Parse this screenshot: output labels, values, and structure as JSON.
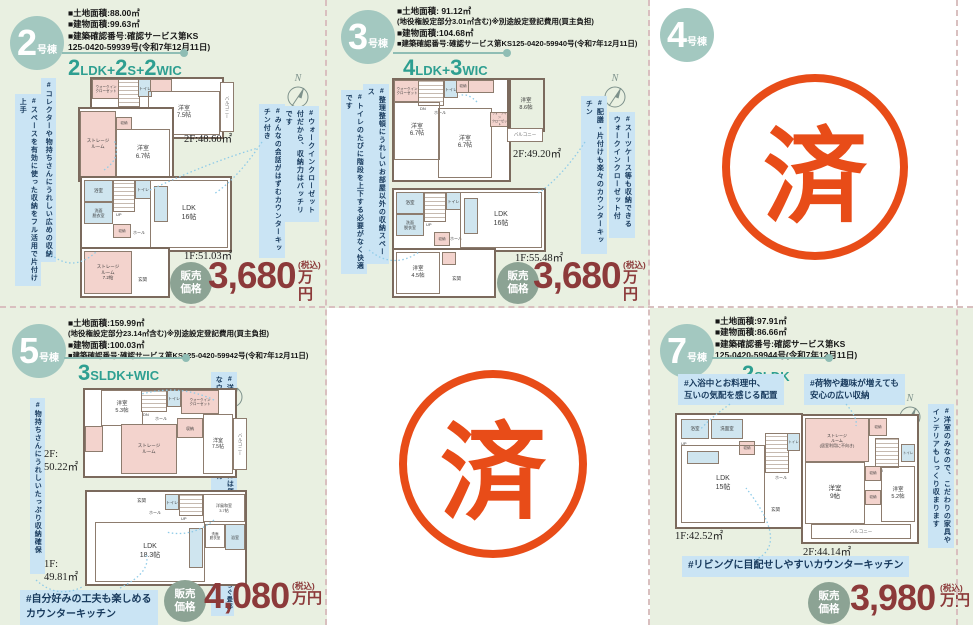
{
  "plus": "+",
  "compass_n": "N",
  "stamp": "済",
  "price_badge": "販売\n価格",
  "units": {
    "u2": {
      "num": "2",
      "suffix": "号棟",
      "specs": [
        "■土地面積:88.00㎡",
        "■建物面積:99.63㎡",
        "■建築確認番号:確認サービス第KS",
        "125-0420-59939号(令和7年12月11日)"
      ],
      "layout": [
        {
          "n": "2",
          "t": "LDK"
        },
        {
          "n": "2",
          "t": "S"
        },
        {
          "n": "2",
          "t": "WIC"
        }
      ],
      "tags": {
        "l1": "#コレクターや物持ちさんにうれしい広めの収納",
        "l2": "#スペースを有効に使った収納をフル活用で片付け上手",
        "r1": "#みんなの会話がはずむカウンターキッチン付き",
        "r2": "#ウォークインクローゼット付だから、収納力はバッチリです"
      },
      "plan2f": {
        "area": "2F:48.60㎡",
        "rooms": {
          "wic1": "ウォークイン\nクローゼット",
          "toilet": "トイレ",
          "dn": "DN",
          "hall": "ホール",
          "r1": "洋室\n7.5帖",
          "storage": "ストレージ\nルーム",
          "closet": "収納",
          "r2": "洋室\n6.7帖",
          "balcony": "バルコニー"
        }
      },
      "plan1f": {
        "area": "1F:51.03㎡",
        "rooms": {
          "bath": "浴室",
          "wash": "洗面\n脱衣室",
          "toilet": "トイレ",
          "up": "UP",
          "closet": "収納",
          "hall": "ホール",
          "ldk": "LDK\n16帖",
          "entry": "玄関",
          "storage": "ストレージ\nルーム\n7.2帖"
        }
      },
      "price": {
        "amount": "3,680",
        "tax": "(税込)",
        "unit": "万円"
      }
    },
    "u3": {
      "num": "3",
      "suffix": "号棟",
      "specs": [
        "■土地面積: 91.12㎡",
        "(地役権設定部分3.01㎡含む)※別途設定登記費用(買主負担)",
        "■建物面積:104.68㎡",
        "■建築確認番号:確認サービス第KS125-0420-59940号(令和7年12月11日)"
      ],
      "layout": [
        {
          "n": "4",
          "t": "LDK"
        },
        {
          "n": "3",
          "t": "WIC"
        }
      ],
      "tags": {
        "l1": "#整理整頓にうれしいお部屋以外の収納スペース",
        "l2": "#トイレのたびに階段を上下する必要がなく快適です",
        "r1": "#配膳・片付けも楽々のカウンターキッチン",
        "r2": "#スーツケース等も収納できるウォークインクローゼット付"
      },
      "plan2f": {
        "area": "2F:49.20㎡",
        "rooms": {
          "wic1": "ウォークイン\nクローゼット",
          "toilet": "トイレ",
          "closet": "収納",
          "r1": "洋室\n6.7帖",
          "r2": "洋室\n6.7帖",
          "r3": "洋室\n8.6帖",
          "wic3": "ウォークイン\nクローゼット",
          "dn": "DN",
          "hall": "ホール",
          "balcony": "バルコニー"
        }
      },
      "plan1f": {
        "area": "1F:55.48㎡",
        "rooms": {
          "bath": "浴室",
          "wash": "洗面\n脱衣室",
          "toilet": "トイレ",
          "up": "UP",
          "closet": "収納",
          "hall": "ホール",
          "ldk": "LDK\n16帖",
          "r1": "洋室\n4.5帖",
          "entry": "玄関"
        }
      },
      "price": {
        "amount": "3,680",
        "tax": "(税込)",
        "unit": "万円"
      }
    },
    "u4": {
      "num": "4",
      "suffix": "号棟"
    },
    "u5": {
      "num": "5",
      "suffix": "号棟",
      "specs": [
        "■土地面積:159.99㎡",
        "(地役権設定部分23.14㎡含む)※別途設定登記費用(買主負担)",
        "■建物面積:100.03㎡",
        "■建築確認番号:確認サービス第KS125-0420-59942号(令和7年12月11日)"
      ],
      "layout": [
        {
          "n": "3",
          "t": "SLDK"
        },
        {
          "n": "",
          "t": "WIC"
        }
      ],
      "tags": {
        "l1": "#物持ちさんにうれしいたっぷり収納確保",
        "r1": "#洋服好きや衣装持ちの方には便利なウォークインクロゼット有",
        "r2": "#ホッと一息、心が安らぐ畳部屋",
        "b1": "#自分好みの工夫も楽しめる\nカウンターキッチン"
      },
      "plan2f": {
        "area": "2F:\n50.22㎡",
        "rooms": {
          "r1": "洋室\n5.3帖",
          "dn": "DN",
          "hall": "ホール",
          "toilet": "トイレ",
          "wic": "ウォークイン\nクローゼット",
          "storage": "ストレージ\nルーム",
          "closet": "収納",
          "r2": "洋室\n7.5帖",
          "balcony": "バルコニー"
        }
      },
      "plan1f": {
        "area": "1F:\n49.81㎡",
        "rooms": {
          "entry": "玄関",
          "toilet": "トイレ",
          "up": "UP",
          "hall": "ホール",
          "sr": "洋風和室\n3.7帖",
          "ldk": "LDK\n18.3帖",
          "wash": "洗面\n脱衣室",
          "bath": "浴室"
        }
      },
      "price": {
        "amount": "4,080",
        "tax": "(税込)",
        "unit": "万円"
      }
    },
    "u7": {
      "num": "7",
      "suffix": "号棟",
      "specs": [
        "■土地面積:97.91㎡",
        "■建物面積:86.66㎡",
        "■建築確認番号:確認サービス第KS",
        "125-0420-59944号(令和7年12月11日)"
      ],
      "layout": [
        {
          "n": "2",
          "t": "SLDK"
        }
      ],
      "tags": {
        "t1": "#入浴中とお料理中、\n互いの気配を感じる配置",
        "t2": "#荷物や趣味が増えても\n安心の広い収納",
        "r1": "#洋室のみなので、こだわりの家具やインテリアもしっくり収まります",
        "b1": "#リビングに目配せしやすいカウンターキッチン"
      },
      "plan1f": {
        "area": "1F:42.52㎡",
        "rooms": {
          "up": "UP",
          "bath": "浴室",
          "wash": "洗面室",
          "closet": "収納",
          "ldk": "LDK\n15帖",
          "toilet": "トイレ",
          "hall": "ホール",
          "entry": "玄関"
        }
      },
      "plan2f": {
        "area": "2F:44.14㎡",
        "rooms": {
          "storage": "ストレージ\nルーム\n(居室利用に不向き)",
          "closet1": "収納",
          "dn": "DN",
          "hall": "ホール",
          "toilet": "トイレ",
          "r1": "洋室\n9帖",
          "closet2": "収納",
          "closet3": "収納",
          "r2": "洋室\n5.2帖",
          "balcony": "バルコニー"
        }
      },
      "price": {
        "amount": "3,980",
        "tax": "(税込)",
        "unit": "万円"
      }
    }
  }
}
